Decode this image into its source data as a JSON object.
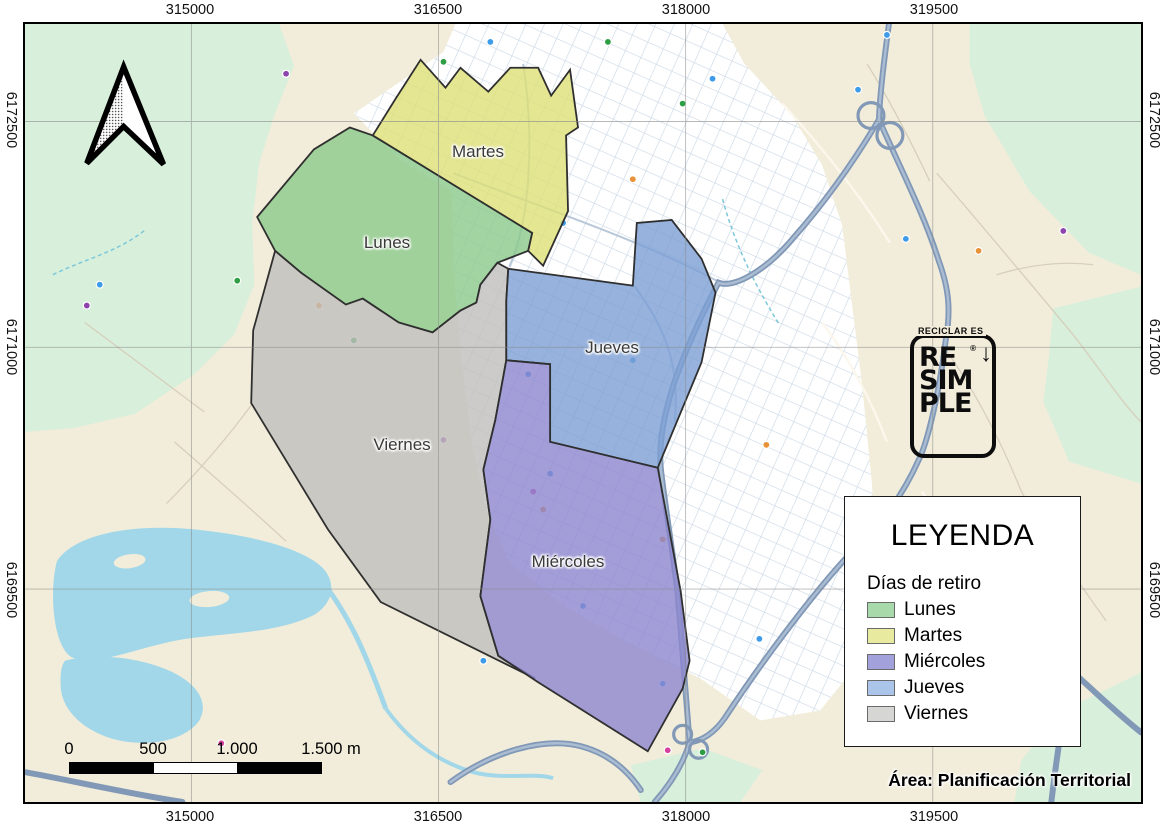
{
  "axis": {
    "top": [
      "315000",
      "316500",
      "318000",
      "319500"
    ],
    "bottom": [
      "315000",
      "316500",
      "318000",
      "319500"
    ],
    "left": [
      "6172500",
      "6171000",
      "6169500"
    ],
    "right": [
      "6172500",
      "6171000",
      "6169500"
    ]
  },
  "zones": [
    {
      "label": "Lunes",
      "fill": "#8bc98b"
    },
    {
      "label": "Martes",
      "fill": "#dde077"
    },
    {
      "label": "Miércoles",
      "fill": "#8c86ce"
    },
    {
      "label": "Jueves",
      "fill": "#7c9fd5"
    },
    {
      "label": "Viernes",
      "fill": "#bfbebb"
    }
  ],
  "legend": {
    "title": "LEYENDA",
    "subtitle": "Días de retiro",
    "items": [
      {
        "label": "Lunes",
        "color": "#a8d9aa"
      },
      {
        "label": "Martes",
        "color": "#e8eb9f"
      },
      {
        "label": "Miércoles",
        "color": "#a3a1dc"
      },
      {
        "label": "Jueves",
        "color": "#aac5e9"
      },
      {
        "label": "Viernes",
        "color": "#d6d6d4"
      }
    ]
  },
  "logo": {
    "tagline": "RECICLAR ES",
    "line1": "RE",
    "line2": "SIM",
    "line3": "PLE",
    "registered": "®",
    "arrow": "↓"
  },
  "scalebar": {
    "labels": [
      "0",
      "500",
      "1.000",
      "1.500 m"
    ]
  },
  "credit": "Área: Planificación Territorial",
  "base_colors": {
    "vegetation": "#d7efdb",
    "land": "#f2edda",
    "water": "#a1d7e9",
    "urban": "#ffffff",
    "major_road": "#8198b6",
    "grid_line": "#8a8a8a"
  }
}
